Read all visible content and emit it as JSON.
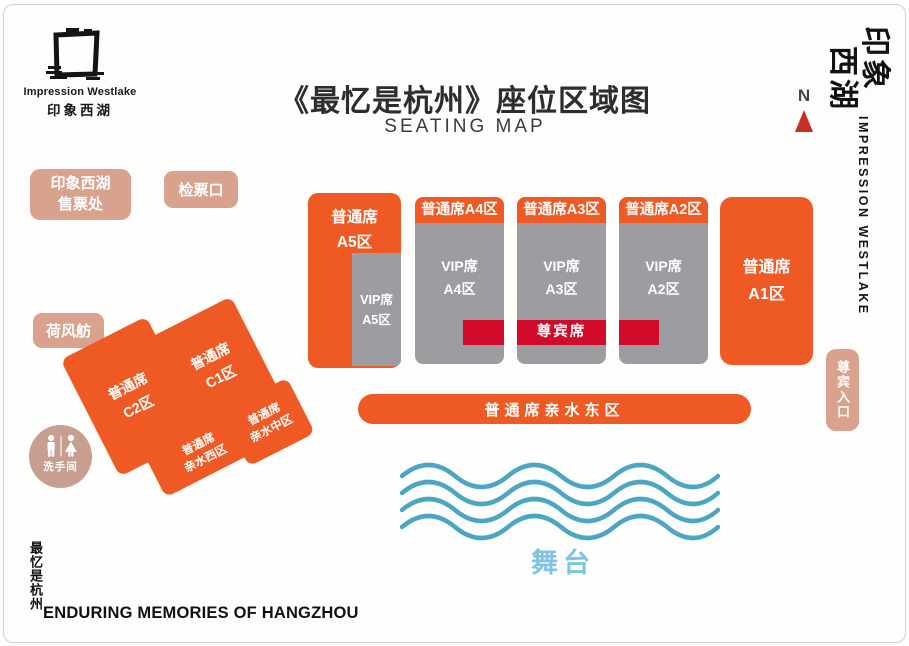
{
  "colors": {
    "orange": "#ef5a24",
    "gray": "#9b9da0",
    "red": "#d20a2a",
    "salmon": "#d8a28c",
    "wave_blue": "#4aa6c3",
    "stage_blue": "#7fc4e2",
    "north_arrow_red": "#c92e22"
  },
  "brand": {
    "name": "Impression Westlake",
    "name_cn": "印象西湖"
  },
  "header": {
    "title": "《最忆是杭州》座位区域图",
    "subtitle": "SEATING MAP"
  },
  "compass": {
    "north_label": "N"
  },
  "side_right": {
    "logo_cn_line1": "印象",
    "logo_cn_line2": "西湖",
    "vertical_label": "IMPRESSION WESTLAKE"
  },
  "facilities": {
    "ticket_office_line1": "印象西湖",
    "ticket_office_line2": "售票处",
    "check_gate": "检票口",
    "hefengfang": "荷风舫",
    "restroom": "洗手间",
    "vip_entrance": "尊宾入口"
  },
  "zones": {
    "a5_regular": {
      "line1": "普通席",
      "line2": "A5区"
    },
    "a5_vip": {
      "line1": "VIP席",
      "line2": "A5区"
    },
    "a4": {
      "header": "普通席A4区",
      "vip_line1": "VIP席",
      "vip_line2": "A4区"
    },
    "a3": {
      "header": "普通席A3区",
      "vip_line1": "VIP席",
      "vip_line2": "A3区",
      "premium_label": "尊宾席"
    },
    "a2": {
      "header": "普通席A2区",
      "vip_line1": "VIP席",
      "vip_line2": "A2区"
    },
    "a1": {
      "line1": "普通席",
      "line2": "A1区"
    },
    "east_waterfront": "普通席亲水东区",
    "c1": {
      "line1": "普通席",
      "line2": "C1区"
    },
    "c2": {
      "line1": "普通席",
      "line2": "C2区"
    },
    "west_waterfront": {
      "line1": "普通席",
      "line2": "亲水西区"
    },
    "mid_waterfront": {
      "line1": "普通席",
      "line2": "亲水中区"
    }
  },
  "stage": {
    "label": "舞台"
  },
  "footer": {
    "vertical_title": "最忆是杭州",
    "english_title": "ENDURING MEMORIES OF HANGZHOU"
  }
}
